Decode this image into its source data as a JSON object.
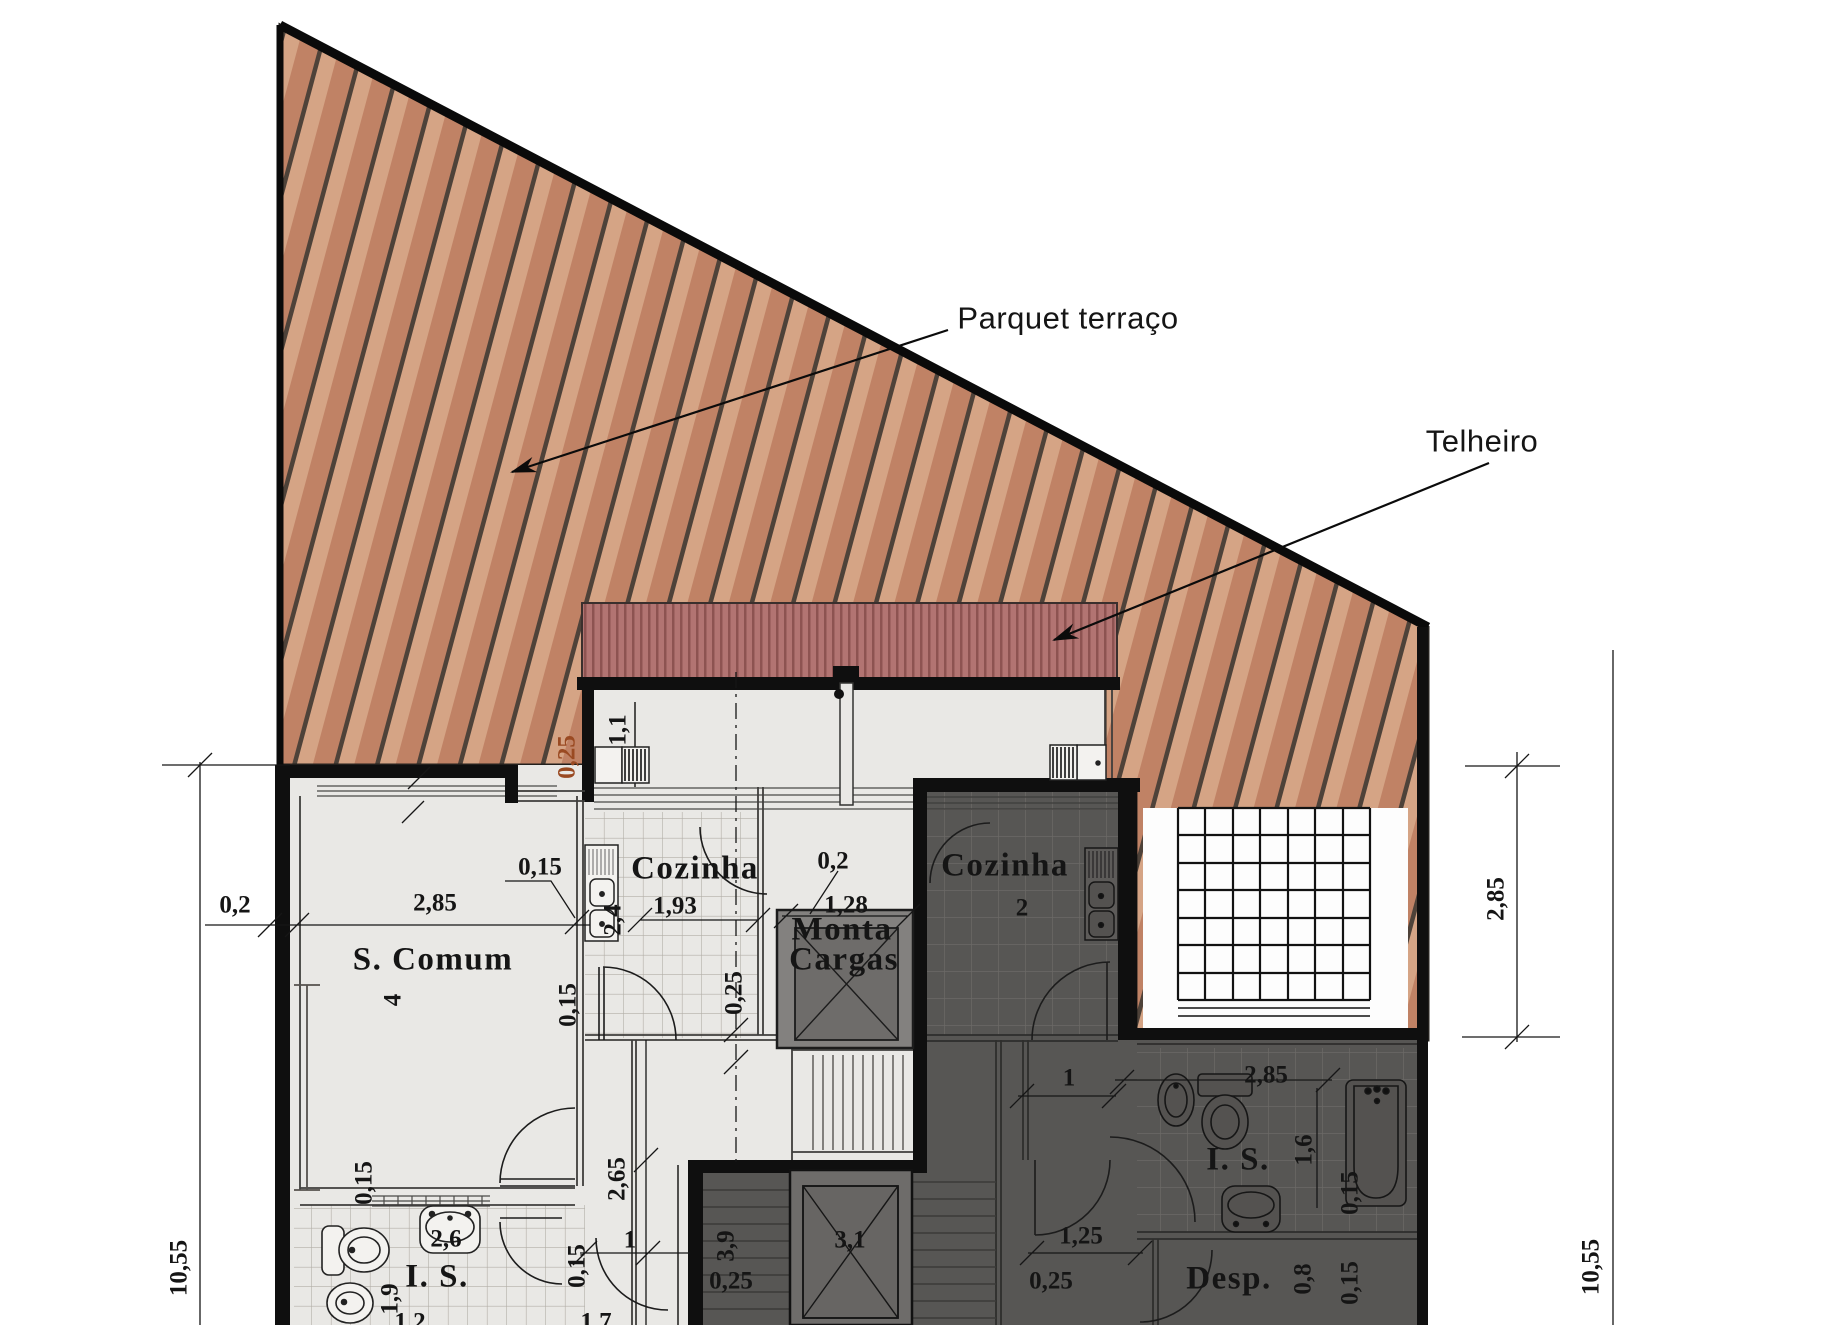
{
  "title": "Floor plan - terrace level",
  "annotations": {
    "parquet": "Parquet terraço",
    "telheiro": "Telheiro"
  },
  "palette": {
    "wood_base": "#cb9478",
    "wood_light": "#d8ac8e",
    "wood_dark": "#bb8166",
    "wood_line": "#4e4239",
    "roof_base": "#b27472",
    "roof_line": "#8d5351",
    "floor_light": "#e9e8e5",
    "floor_dark": "#575654",
    "wall": "#0f0f0f",
    "red_dim_color": "#9a4a22",
    "courtyard": "#fdfdfd"
  },
  "labels": [
    {
      "name": "annotation-parquet-terraco",
      "text": "Parquet terraço"
    },
    {
      "name": "annotation-telheiro",
      "text": "Telheiro"
    },
    {
      "name": "room-label-s-comum",
      "text": "S. Comum"
    },
    {
      "name": "room-label-cozinha-left",
      "text": "Cozinha"
    },
    {
      "name": "room-label-monta",
      "text": "Monta"
    },
    {
      "name": "room-label-cargas",
      "text": "Cargas"
    },
    {
      "name": "room-label-cozinha-right",
      "text": "Cozinha"
    },
    {
      "name": "room-label-is-left",
      "text": "I. S."
    },
    {
      "name": "room-label-is-right",
      "text": "I. S."
    },
    {
      "name": "room-label-desp",
      "text": "Desp."
    },
    {
      "name": "dim-0-2-left",
      "text": "0,2"
    },
    {
      "name": "dim-2-85-scomum",
      "text": "2,85"
    },
    {
      "name": "dim-0-15-sink",
      "text": "0,15"
    },
    {
      "name": "dim-4-scomum",
      "text": "4"
    },
    {
      "name": "dim-2-4-kitchen",
      "text": "2,4"
    },
    {
      "name": "dim-0-25-red",
      "text": "0,25",
      "color": "#9a4a22"
    },
    {
      "name": "dim-1-1-terrace",
      "text": "1,1"
    },
    {
      "name": "dim-1-93-kitchen",
      "text": "1,93"
    },
    {
      "name": "dim-0-2-shaft",
      "text": "0,2"
    },
    {
      "name": "dim-1-28-shaft",
      "text": "1,28"
    },
    {
      "name": "dim-0-25-mid",
      "text": "0,25"
    },
    {
      "name": "dim-0-15-mid",
      "text": "0,15"
    },
    {
      "name": "dim-2-65-hall",
      "text": "2,65"
    },
    {
      "name": "dim-0-15-isleft",
      "text": "0,15"
    },
    {
      "name": "dim-2-6-sink",
      "text": "2,6"
    },
    {
      "name": "dim-1-9-is",
      "text": "1,9"
    },
    {
      "name": "dim-1-door-left",
      "text": "1"
    },
    {
      "name": "dim-0-15-door",
      "text": "0,15"
    },
    {
      "name": "dim-3-9-stair",
      "text": "3,9"
    },
    {
      "name": "dim-0-25-stair",
      "text": "0,25"
    },
    {
      "name": "dim-3-1-lift",
      "text": "3,1"
    },
    {
      "name": "dim-1-2-bottom",
      "text": "1,2"
    },
    {
      "name": "dim-1-7-bottom",
      "text": "1,7"
    },
    {
      "name": "dim-2-cozinha-right",
      "text": "2"
    },
    {
      "name": "dim-1-door-right",
      "text": "1"
    },
    {
      "name": "dim-1-25-right",
      "text": "1,25"
    },
    {
      "name": "dim-0-25-right",
      "text": "0,25"
    },
    {
      "name": "dim-2-85-isright",
      "text": "2,85"
    },
    {
      "name": "dim-1-6-isright",
      "text": "1,6"
    },
    {
      "name": "dim-0-15-isright",
      "text": "0,15"
    },
    {
      "name": "dim-0-8-desp",
      "text": "0,8"
    },
    {
      "name": "dim-0-15-desp",
      "text": "0,15"
    },
    {
      "name": "dim-2-85-outer-right",
      "text": "2,85"
    },
    {
      "name": "dim-10-55-right",
      "text": "10,55"
    },
    {
      "name": "dim-10-55-left",
      "text": "10,55"
    }
  ]
}
